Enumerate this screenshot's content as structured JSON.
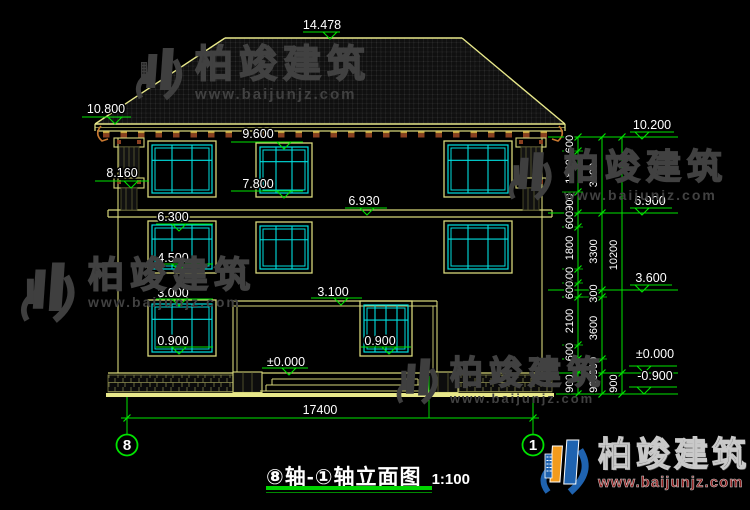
{
  "drawing_title": {
    "text": "⑧轴-①轴立面图",
    "scale": "1:100"
  },
  "watermark": {
    "name": "柏竣建筑",
    "url": "www.baijunjz.com"
  },
  "brand_logo": {
    "name": "柏竣建筑",
    "url": "www.baijunjz.com"
  },
  "axis_bubbles": [
    {
      "label": "8",
      "x": 127
    },
    {
      "label": "1",
      "x": 533
    }
  ],
  "overall_dimension": {
    "label": "17400",
    "x1": 127,
    "x2": 533,
    "y": 418,
    "tx": 320,
    "ty": 410
  },
  "elevation_markers": {
    "left_and_interior": [
      {
        "label": "14.478",
        "tx": 322,
        "ty": 25,
        "lx1": 303,
        "lx2": 340,
        "ly": 32,
        "ax": 330
      },
      {
        "label": "10.800",
        "tx": 106,
        "ty": 109,
        "lx1": 82,
        "lx2": 131,
        "ly": 117,
        "ax": 115
      },
      {
        "label": "9.600",
        "tx": 258,
        "ty": 134,
        "lx1": 231,
        "lx2": 303,
        "ly": 142,
        "ax": 284
      },
      {
        "label": "8.160",
        "tx": 122,
        "ty": 173,
        "lx1": 95,
        "lx2": 149,
        "ly": 181,
        "ax": 131
      },
      {
        "label": "7.800",
        "tx": 258,
        "ty": 184,
        "lx1": 231,
        "lx2": 303,
        "ly": 191,
        "ax": 284
      },
      {
        "label": "6.300",
        "tx": 173,
        "ty": 217,
        "lx1": 156,
        "lx2": 213,
        "ly": 224,
        "ax": 179
      },
      {
        "label": "6.930",
        "tx": 364,
        "ty": 201,
        "lx1": 345,
        "lx2": 387,
        "ly": 208,
        "ax": 367
      },
      {
        "label": "4.500",
        "tx": 173,
        "ty": 258,
        "lx1": 156,
        "lx2": 213,
        "ly": 264,
        "ax": 179
      },
      {
        "label": "3.000",
        "tx": 173,
        "ty": 293,
        "lx1": 156,
        "lx2": 213,
        "ly": 299,
        "ax": 179
      },
      {
        "label": "3.100",
        "tx": 333,
        "ty": 292,
        "lx1": 311,
        "lx2": 362,
        "ly": 298,
        "ax": 341
      },
      {
        "label": "0.900",
        "tx": 173,
        "ty": 341,
        "lx1": 156,
        "lx2": 213,
        "ly": 347,
        "ax": 179
      },
      {
        "label": "0.900",
        "tx": 380,
        "ty": 341,
        "lx1": 361,
        "lx2": 411,
        "ly": 347,
        "ax": 389
      },
      {
        "label": "±0.000",
        "tx": 286,
        "ty": 362,
        "lx1": 262,
        "lx2": 308,
        "ly": 368,
        "ax": 289
      }
    ],
    "right": [
      {
        "label": "10.200",
        "tx": 652,
        "ty": 125,
        "lx1": 630,
        "lx2": 674,
        "ly": 132,
        "ax": 642
      },
      {
        "label": "6.900",
        "tx": 650,
        "ty": 201,
        "lx1": 630,
        "lx2": 672,
        "ly": 208,
        "ax": 642
      },
      {
        "label": "3.600",
        "tx": 651,
        "ty": 278,
        "lx1": 630,
        "lx2": 672,
        "ly": 285,
        "ax": 642
      },
      {
        "label": "±0.000",
        "tx": 655,
        "ty": 354,
        "lx1": 629,
        "lx2": 677,
        "ly": 366,
        "ax": 644
      },
      {
        "label": "-0.900",
        "tx": 655,
        "ty": 376,
        "lx1": 629,
        "lx2": 677,
        "ly": 387,
        "ax": 644
      }
    ]
  },
  "right_dimension_chains": [
    {
      "x": 578,
      "label_x": 570,
      "ticks": [
        137,
        151,
        192,
        213,
        227,
        269,
        283,
        297,
        345,
        359,
        373,
        394
      ],
      "labels": [
        "600",
        "1800",
        "900",
        "600",
        "1800",
        "600",
        "600",
        "2100",
        "600",
        "",
        "900"
      ]
    },
    {
      "x": 602,
      "label_x": 594,
      "ticks": [
        137,
        213,
        290,
        297,
        359,
        373,
        394
      ],
      "labels": [
        "3300",
        "3300",
        "300",
        "3600",
        "300",
        "900"
      ]
    },
    {
      "x": 622,
      "label_x": 614,
      "ticks": [
        137,
        373,
        394
      ],
      "labels": [
        "10200",
        "900"
      ]
    }
  ],
  "level_lines_right": [
    137,
    213,
    290,
    373,
    394
  ],
  "colors": {
    "background": "#000000",
    "line": "#d6d67a",
    "line_bright": "#e8e88a",
    "dim_green": "#00e400",
    "glazing_cyan": "#00dede",
    "corbel_red": "#8a4020",
    "corbel_trim": "#c8a23c",
    "hook_orange": "#c87830",
    "text_white": "#ffffff",
    "watermark_gray": "#3f3f3f",
    "brand_blue": "#1f63b0",
    "brand_orange": "#f29b1d",
    "brand_red": "#8e1f1f",
    "underline_green": "#00d400"
  }
}
